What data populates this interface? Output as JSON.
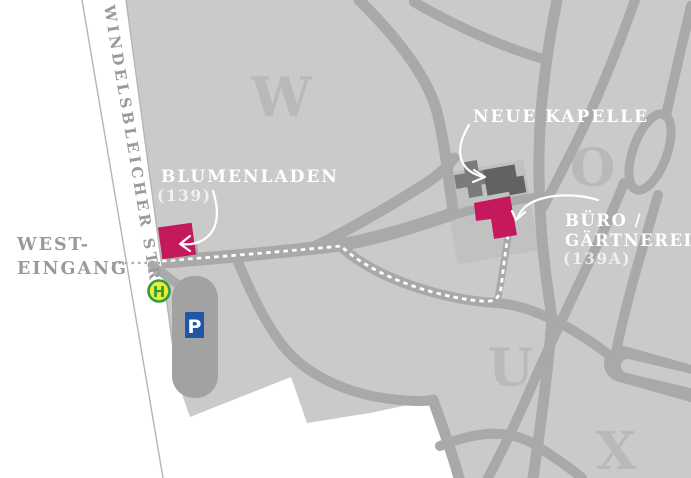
{
  "colors": {
    "highlight": "#c5195e",
    "map_bg": "#cacaca",
    "road": "#a9a9a9",
    "section_letter": "#b9b9b9",
    "building_dark": "#626262",
    "bus_fill": "#f3e933",
    "bus_green": "#2f9e41",
    "parking_blue": "#1d57a5",
    "label_gray": "#9a9a9a"
  },
  "street": {
    "name": "WINDELSBLEICHER STR."
  },
  "entrance": {
    "line1": "WEST-",
    "line2": "EINGANG"
  },
  "labels": {
    "flower_shop": {
      "name": "BLUMENLADEN",
      "number": "(139)"
    },
    "chapel": {
      "name": "NEUE KAPELLE"
    },
    "office": {
      "line1": "BÜRO /",
      "line2": "GÄRTNEREI",
      "number": "(139A)"
    }
  },
  "sections": {
    "w": "W",
    "o": "O",
    "u": "U",
    "x": "X"
  },
  "icons": {
    "bus_stop_label": "H",
    "parking_label": "P"
  }
}
